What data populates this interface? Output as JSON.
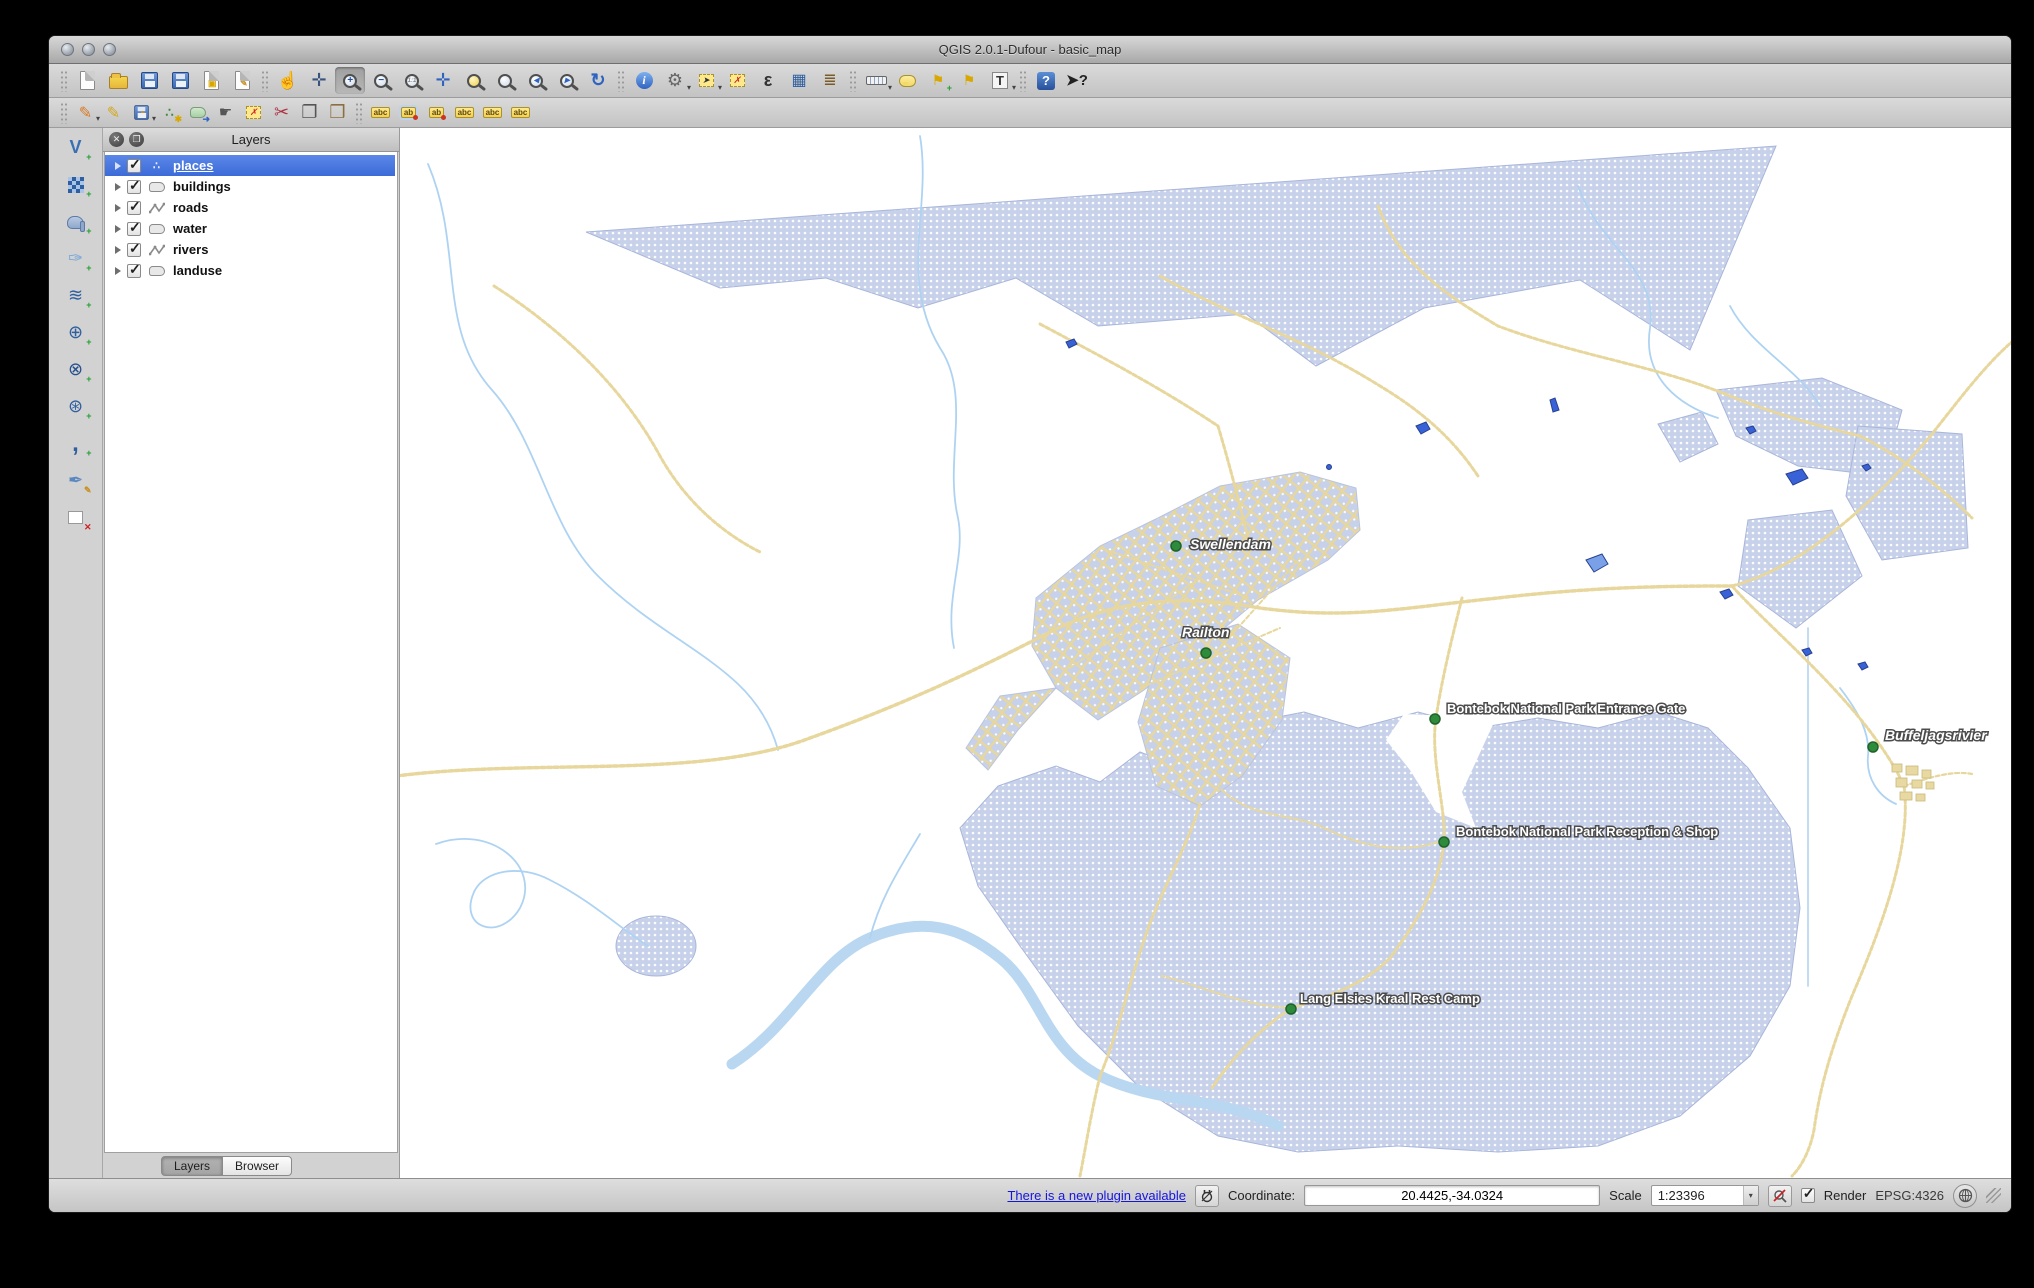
{
  "window": {
    "title": "QGIS 2.0.1-Dufour - basic_map"
  },
  "ui": {
    "caret": "▾",
    "close_glyph": "✕",
    "float_glyph": "❐",
    "check_glyph": "✓"
  },
  "toolbar_main": {
    "items": [
      {
        "name": "new-project",
        "glyph": ""
      },
      {
        "name": "open-project",
        "glyph": ""
      },
      {
        "name": "save-project",
        "glyph": ""
      },
      {
        "name": "save-project-as",
        "glyph": ""
      },
      {
        "name": "new-print-composer",
        "glyph": ""
      },
      {
        "name": "composer-manager",
        "glyph": ""
      },
      {
        "name": "pan-map",
        "glyph": "☝"
      },
      {
        "name": "pan-to-selection",
        "glyph": "✛"
      },
      {
        "name": "zoom-in",
        "glyph": "+"
      },
      {
        "name": "zoom-out",
        "glyph": "−"
      },
      {
        "name": "zoom-native",
        "glyph": "1:1"
      },
      {
        "name": "zoom-full",
        "glyph": "✛"
      },
      {
        "name": "zoom-to-selection",
        "glyph": ""
      },
      {
        "name": "zoom-to-layer",
        "glyph": ""
      },
      {
        "name": "zoom-last",
        "glyph": "◂"
      },
      {
        "name": "zoom-next",
        "glyph": "▸"
      },
      {
        "name": "refresh-map",
        "glyph": "↻"
      },
      {
        "name": "identify-features",
        "glyph": "i"
      },
      {
        "name": "run-feature-action",
        "glyph": "⚙"
      },
      {
        "name": "select-features",
        "glyph": "➤"
      },
      {
        "name": "deselect-features",
        "glyph": "✗"
      },
      {
        "name": "select-by-expression",
        "glyph": "ε"
      },
      {
        "name": "open-attribute-table",
        "glyph": "▦"
      },
      {
        "name": "field-calculator",
        "glyph": "≣"
      },
      {
        "name": "measure",
        "glyph": ""
      },
      {
        "name": "map-tips",
        "glyph": ""
      },
      {
        "name": "new-bookmark",
        "glyph": "⚑"
      },
      {
        "name": "show-bookmarks",
        "glyph": "⚑"
      },
      {
        "name": "text-annotation",
        "glyph": "T"
      },
      {
        "name": "help",
        "glyph": "?"
      },
      {
        "name": "whats-this",
        "glyph": "➤?"
      }
    ]
  },
  "toolbar_edit": {
    "items": [
      {
        "name": "current-edits",
        "glyph": "✎"
      },
      {
        "name": "toggle-editing",
        "glyph": "✎"
      },
      {
        "name": "save-layer-edits",
        "glyph": ""
      },
      {
        "name": "add-feature",
        "glyph": "∴"
      },
      {
        "name": "move-feature",
        "glyph": "➜"
      },
      {
        "name": "node-tool",
        "glyph": "☛"
      },
      {
        "name": "delete-selected",
        "glyph": "✗"
      },
      {
        "name": "cut-features",
        "glyph": "✂"
      },
      {
        "name": "copy-features",
        "glyph": "❐"
      },
      {
        "name": "paste-features",
        "glyph": "❒"
      },
      {
        "name": "layer-labeling-options",
        "glyph": "abc"
      },
      {
        "name": "label-pin",
        "glyph": "ab"
      },
      {
        "name": "label-move",
        "glyph": "ab"
      },
      {
        "name": "label-rotate",
        "glyph": "abc"
      },
      {
        "name": "label-change",
        "glyph": "abc"
      },
      {
        "name": "label-properties",
        "glyph": "abc"
      }
    ]
  },
  "side_toolbar": {
    "items": [
      {
        "name": "add-vector-layer",
        "glyph": "V"
      },
      {
        "name": "add-raster-layer",
        "glyph": ""
      },
      {
        "name": "add-postgis-layer",
        "glyph": ""
      },
      {
        "name": "add-spatialite-layer",
        "glyph": "✑"
      },
      {
        "name": "add-mssql-layer",
        "glyph": "≋"
      },
      {
        "name": "add-wms-layer",
        "glyph": "⊕"
      },
      {
        "name": "add-wcs-layer",
        "glyph": "⊗"
      },
      {
        "name": "add-wfs-layer",
        "glyph": "⊛"
      },
      {
        "name": "add-delimited-text-layer",
        "glyph": ","
      },
      {
        "name": "new-shapefile-layer",
        "glyph": "✒"
      },
      {
        "name": "remove-layer",
        "glyph": "✕"
      }
    ]
  },
  "layers_panel": {
    "title": "Layers",
    "items": [
      {
        "label": "places",
        "checked": true,
        "selected": true,
        "geometry": "point"
      },
      {
        "label": "buildings",
        "checked": true,
        "selected": false,
        "geometry": "polygon"
      },
      {
        "label": "roads",
        "checked": true,
        "selected": false,
        "geometry": "line"
      },
      {
        "label": "water",
        "checked": true,
        "selected": false,
        "geometry": "polygon"
      },
      {
        "label": "rivers",
        "checked": true,
        "selected": false,
        "geometry": "line"
      },
      {
        "label": "landuse",
        "checked": true,
        "selected": false,
        "geometry": "polygon"
      }
    ],
    "tabs": [
      {
        "label": "Layers",
        "active": true
      },
      {
        "label": "Browser",
        "active": false
      }
    ]
  },
  "map": {
    "labels": [
      {
        "text": "Swellendam"
      },
      {
        "text": "Railton"
      },
      {
        "text": "Bontebok National Park Entrance Gate"
      },
      {
        "text": "Buffeljagsrivier"
      },
      {
        "text": "Bontebok National Park Reception & Shop"
      },
      {
        "text": "Lang Elsies Kraal Rest Camp"
      }
    ],
    "colors": {
      "landuse_fill": "#c7d1ea",
      "road": "#e7d79d",
      "river": "#aed3f2",
      "water": "#3a62d8",
      "place_marker": "#2e8b3c",
      "selection_blue": "#3c6bd8"
    }
  },
  "status_bar": {
    "plugin_link": "There is a new plugin available",
    "coordinate_label": "Coordinate:",
    "coordinate_value": "20.4425,-34.0324",
    "scale_label": "Scale",
    "scale_value": "1:23396",
    "render_label": "Render",
    "render_checked": true,
    "crs_label": "EPSG:4326"
  }
}
